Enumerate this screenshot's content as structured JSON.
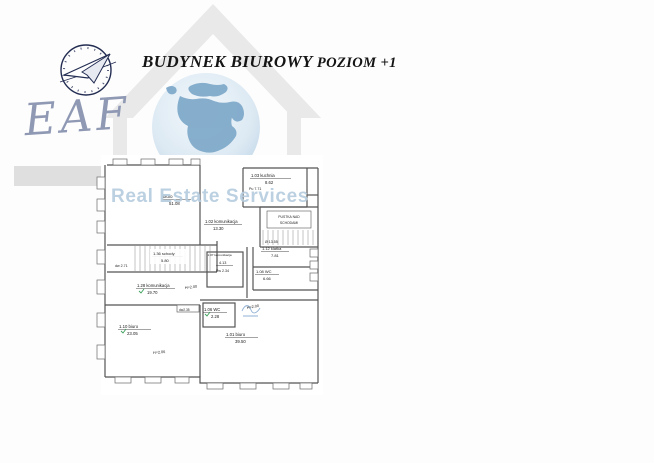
{
  "branding": {
    "logo_text": "EAF",
    "watermark": "Real Estate Services"
  },
  "header": {
    "title_main": "BUDYNEK BIUROWY",
    "title_sub": "POZIOM +1"
  },
  "floor_plan": {
    "rooms": [
      {
        "label": "biuro",
        "area": "51.08"
      },
      {
        "label": "1.03 kuchnia",
        "area": "8.62"
      },
      {
        "label": "1.02 komunikacja",
        "area": "13.30"
      },
      {
        "label": "1.36 schody",
        "area": "5.80"
      },
      {
        "label": "1.07 komunikacja",
        "area": "4.13",
        "note": "Pw 2.34"
      },
      {
        "label": "1.28 komunikacja",
        "area": "19.70"
      },
      {
        "label": "1.12 klatka",
        "area": "7.81"
      },
      {
        "label": "1.08 WC",
        "area": "6.66"
      },
      {
        "label": "1.10 biuro",
        "area": "23.05"
      },
      {
        "label": "1.06 WC",
        "area": "2.28"
      },
      {
        "label": "1.01 biuro",
        "area": "39.50"
      }
    ],
    "annotations": {
      "void_line1": "PUSTKA NAD",
      "void_line2": "SCHODAMI",
      "pu": "Pu 7.71",
      "dia": "Ø 13.55",
      "dw1": "dw 2.71",
      "dw2": "dw2.35",
      "h_corridor": "H=2.00",
      "h_wc": "H=2.00",
      "h_room": "H=2.06"
    }
  },
  "colors": {
    "logo_text": "#8f99b4",
    "watermark_text": "#b6cddf",
    "house_watermark": "#e9e9e9",
    "plan_line": "#555555",
    "survey_tick_green": "#3aa05a",
    "annotation_blue": "#5c7ca8"
  }
}
